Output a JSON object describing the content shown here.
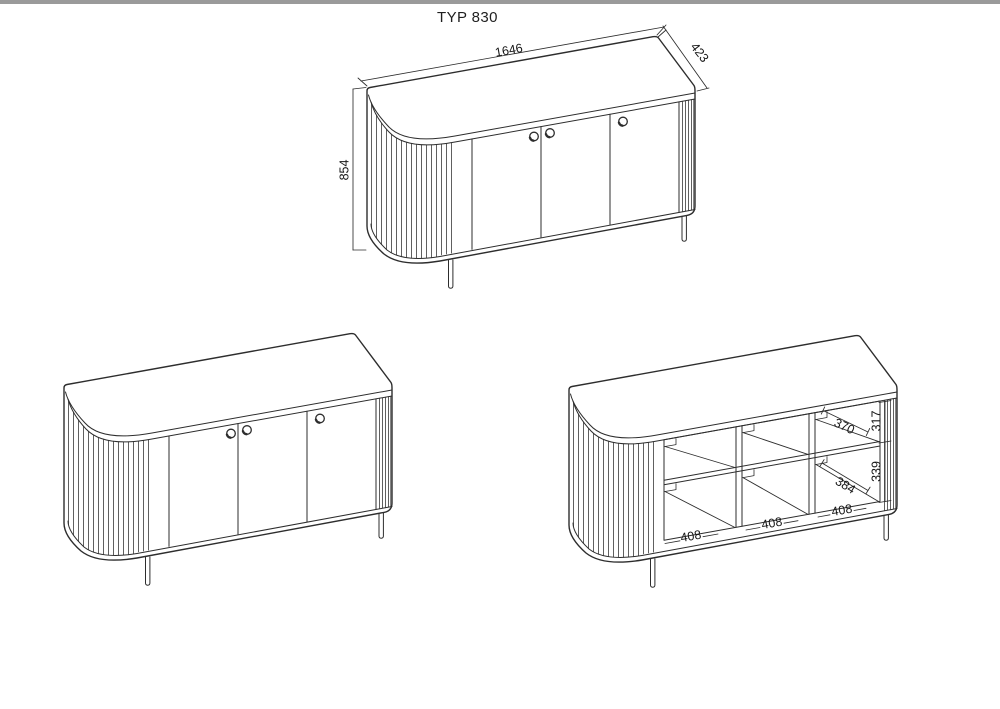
{
  "page": {
    "title": "TYP 830",
    "sheet_border_color": "#9a9a9a",
    "line_color": "#2d2d2d"
  },
  "views": {
    "perspective": {
      "label": "dimensioned perspective view",
      "width_mm": "1646",
      "depth_mm": "423",
      "height_mm": "854"
    },
    "front": {
      "label": "front perspective view"
    },
    "interior": {
      "label": "interior compartment view",
      "compartment_widths_mm": [
        "408",
        "408",
        "408"
      ],
      "top_shelf_depth_mm": "370",
      "top_shelf_height_mm": "317",
      "bottom_shelf_depth_mm": "384",
      "bottom_shelf_height_mm": "339"
    }
  }
}
